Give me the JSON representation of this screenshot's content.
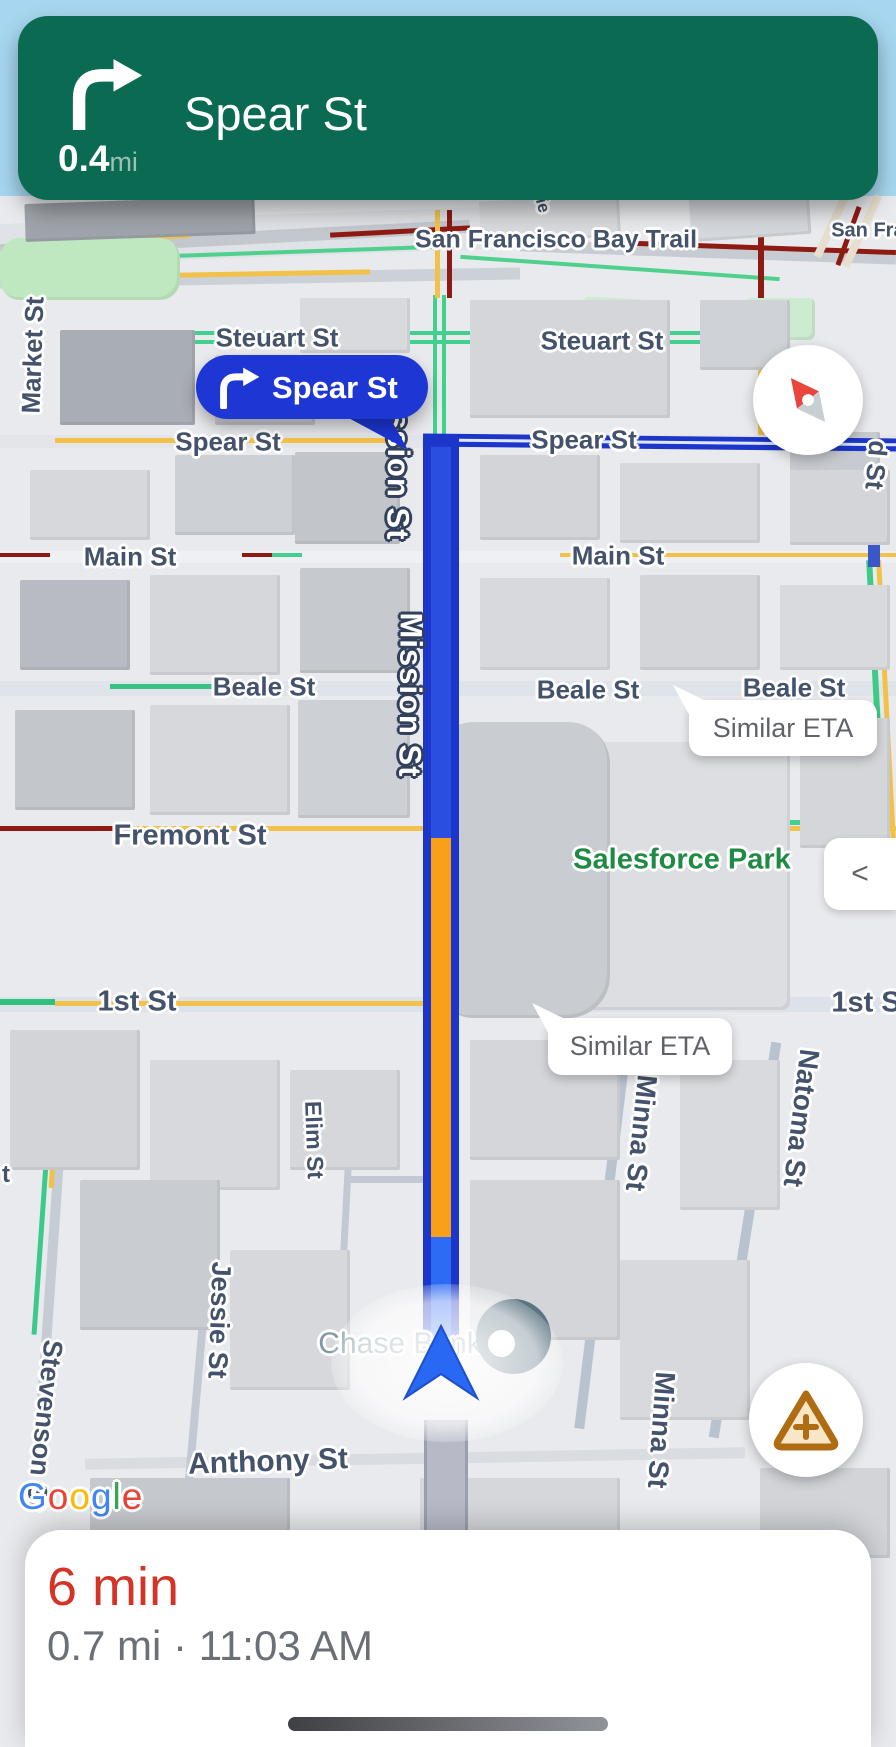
{
  "banner": {
    "distance": "0.4",
    "distance_unit": "mi",
    "instruction": "Spear St",
    "background": "#0a6a52"
  },
  "turn_callout": {
    "label": "Spear St",
    "background": "#1d36d4"
  },
  "eta_bubbles": {
    "beale": "Similar ETA",
    "first": "Similar ETA"
  },
  "street_labels": {
    "bay_trail": "San Francisco Bay Trail",
    "san_fran_partial": "San Fran",
    "pier_partial": "Pie",
    "market": "Market St",
    "steuart_left": "Steuart St",
    "steuart_right": "Steuart St",
    "spear_left": "Spear St",
    "spear_right": "Spear St",
    "main_left": "Main St",
    "main_right": "Main St",
    "beale_left": "Beale St",
    "beale_mid": "Beale St",
    "beale_right": "Beale St",
    "fremont": "Fremont St",
    "first_left": "1st St",
    "first_right": "1st S",
    "mission_upper": "Mission St",
    "mission_lower": "Mission St",
    "minna_upper": "Minna St",
    "minna_lower": "Minna St",
    "natoma": "Natoma St",
    "elim": "Elim St",
    "jessie": "Jessie St",
    "stevenson": "Stevenson St",
    "stevenson_partial": "t",
    "anthony": "Anthony St",
    "howard_partial": "d St"
  },
  "poi_labels": {
    "salesforce_park": "Salesforce Park",
    "chase_bank": "Chase Bank"
  },
  "map_controls": {
    "collapse": "<"
  },
  "bottom_sheet": {
    "eta": "6 min",
    "details": "0.7 mi · 11:03 AM"
  },
  "google_logo": {
    "letters": [
      {
        "ch": "G",
        "color": "#4285F4"
      },
      {
        "ch": "o",
        "color": "#EA4335"
      },
      {
        "ch": "o",
        "color": "#FBBC05"
      },
      {
        "ch": "g",
        "color": "#4285F4"
      },
      {
        "ch": "l",
        "color": "#34A853"
      },
      {
        "ch": "e",
        "color": "#EA4335"
      }
    ]
  },
  "colors": {
    "banner_green": "#0a6a52",
    "route_blue": "#1b36c9",
    "route_inner_blue": "#2a4fe0",
    "traffic_orange": "#f9a01b",
    "traffic_yellow": "#f2c14a",
    "traffic_dark_red": "#8e1b13",
    "water_blue": "#a7d7f0",
    "eta_red": "#d33426",
    "park_green": "#1f8a43"
  }
}
